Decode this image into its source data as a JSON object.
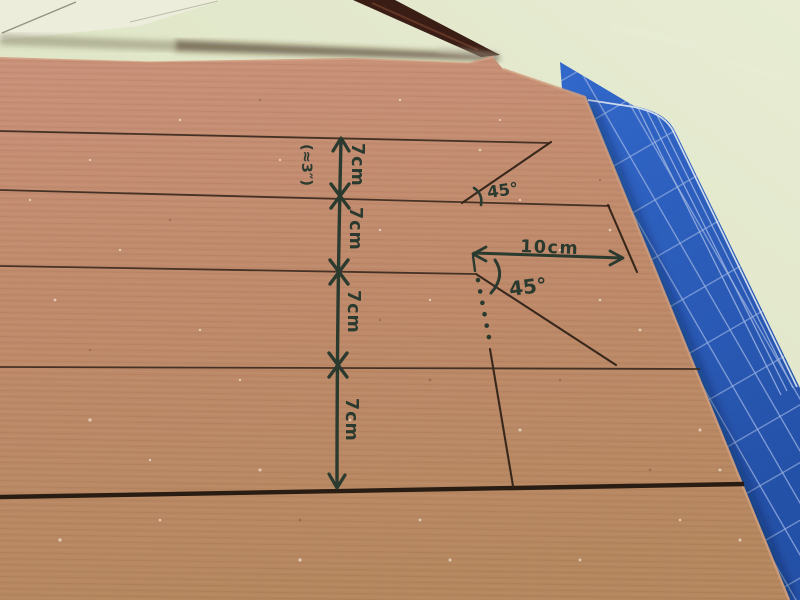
{
  "scene": {
    "subject": "Cardboard sheet marked for cutting, on a green table with a blue cutting mat",
    "colors": {
      "table": "#dfe5c6",
      "cardboard": "#c08a6b",
      "cutting_mat": "#2d60bf",
      "mat_grid": "#9db3e2",
      "marker_ink": "#2b3a2f",
      "ruled_pen_line": "#3d2c20"
    }
  },
  "measurements": {
    "segment_labels": [
      "7cm",
      "7cm",
      "7cm",
      "7cm"
    ],
    "inches_equivalent": "(≈3″)",
    "top_angle": "45°",
    "middle_angle": "45°",
    "horizontal_dimension": "10cm"
  }
}
